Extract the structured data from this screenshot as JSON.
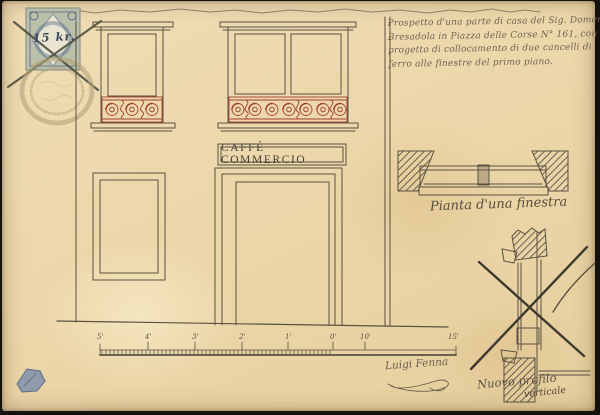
{
  "document_title": "Facade drawing of Caffè Commercio with iron window grille project",
  "stamp": {
    "value": "15 kr."
  },
  "annotation": {
    "lines": [
      "Prospetto d'una parte di casa del Sig. Domenico",
      "Bresadola in Piazza delle Corse N° 161, con",
      "progetto di collocamento di due cancelli di",
      "ferro alle finestre del primo piano."
    ]
  },
  "facade": {
    "sign_text": "CAFFÉ COMMERCIO"
  },
  "details": {
    "plan_label": "Pianta d'una finestra",
    "profile_label": "Nuovo profilo",
    "profile_label_sub": "verticale"
  },
  "signature": {
    "name": "Luigi Fenna"
  },
  "scale_bar": {
    "labels": [
      "5'",
      "4'",
      "3'",
      "2'",
      "1'",
      "0'",
      "10'",
      "15'"
    ]
  },
  "colors": {
    "paper": "#ecd7aa",
    "ink": "#5a5142",
    "railing_red": "#a2402f",
    "stamp_green": "#b4bda8",
    "stamp_blue": "#5c7089",
    "seal": "#b2a47c",
    "photo_border": "#15110d"
  }
}
